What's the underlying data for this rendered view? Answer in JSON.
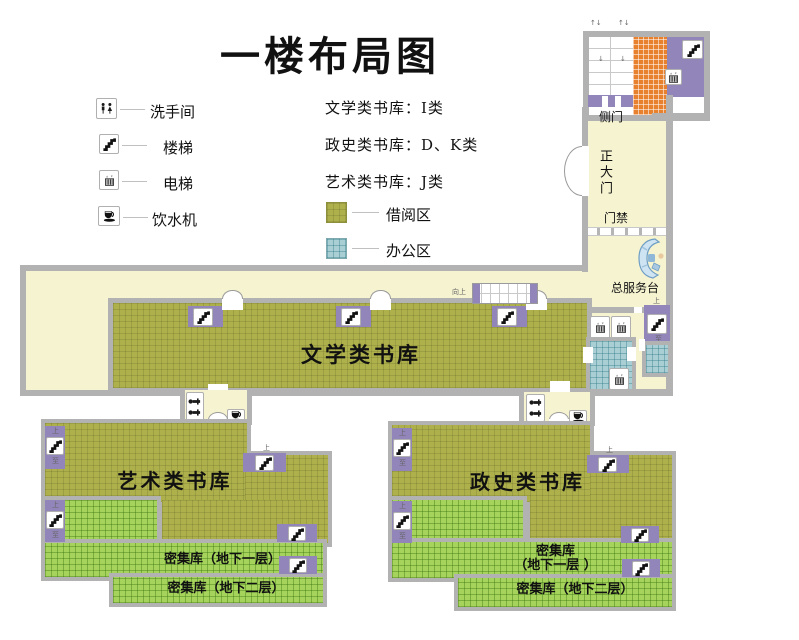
{
  "title": "一楼布局图",
  "legend": {
    "items": [
      {
        "icon": "restroom-icon",
        "label": "洗手间"
      },
      {
        "icon": "stairs-icon",
        "label": "楼梯"
      },
      {
        "icon": "elevator-icon",
        "label": "电梯"
      },
      {
        "icon": "water-dispenser-icon",
        "label": "饮水机"
      }
    ],
    "categories": [
      "文学类书库：I类",
      "政史类书库：D、K类",
      "艺术类书库：J类"
    ],
    "areas": [
      {
        "label": "借阅区",
        "color": "#aeb14b"
      },
      {
        "label": "办公区",
        "color": "#a9cfd5"
      }
    ]
  },
  "rooms": {
    "literature": "文学类书库",
    "art": "艺术类书库",
    "politics": "政史类书库",
    "dense_b1": "密集库（地下一层）",
    "dense_b1_line1": "密集库",
    "dense_b1_line2": "（地下一层 ）",
    "dense_b2": "密集库（地下二层）"
  },
  "annotations": {
    "side_door": "侧门",
    "main_entrance": "正大门",
    "access_gate": "门禁",
    "service_desk": "总服务台",
    "escalator_up": "向上",
    "stair_up": "上",
    "stair_to": "至",
    "updown_mark": "↑↓"
  },
  "colors": {
    "borrow_area": "#aeb14b",
    "office_area": "#a9cfd5",
    "dense_area": "#a5d35c",
    "escalator_zone": "#e8812e",
    "stair_room": "#9285b9",
    "corridor": "#f6f3d0",
    "wall": "#b2b2b2"
  }
}
